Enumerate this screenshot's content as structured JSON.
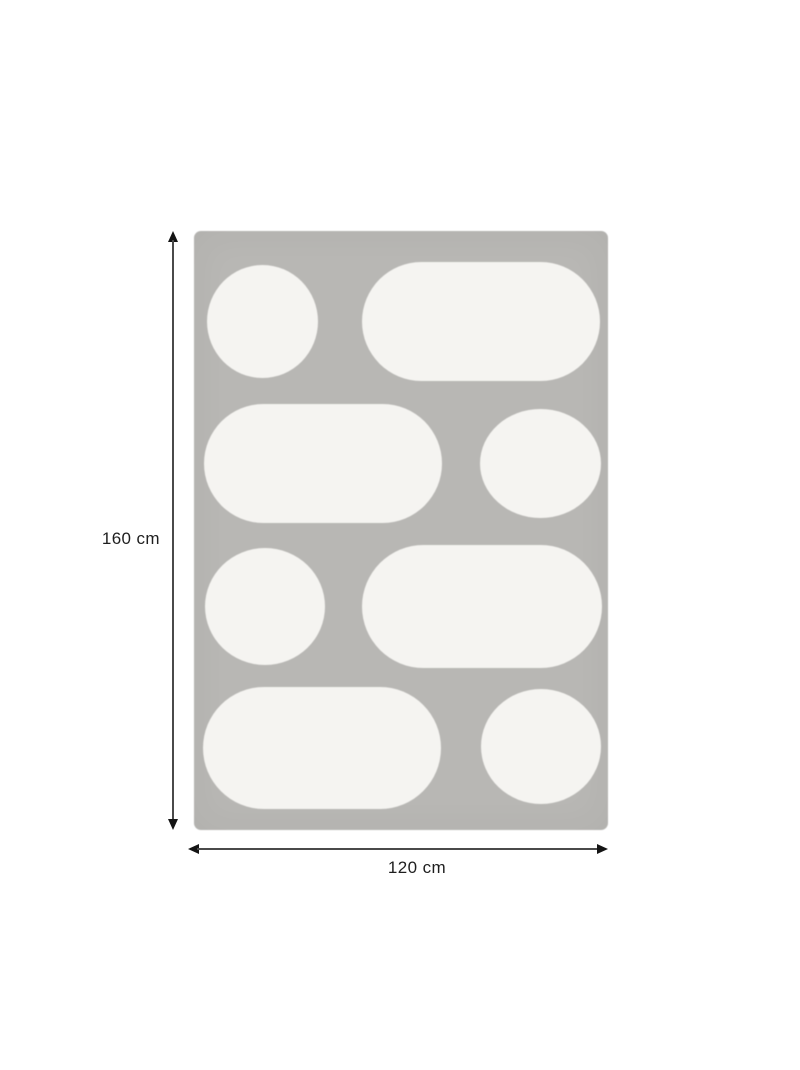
{
  "product": {
    "name": "patterned rug",
    "description": "Grey rectangular rug decorated with eight white rounded motifs (circles and pills) arranged in four rows",
    "pattern_rows": [
      [
        "circle",
        "pill"
      ],
      [
        "pill",
        "circle"
      ],
      [
        "circle",
        "pill"
      ],
      [
        "pill",
        "circle"
      ]
    ]
  },
  "dimensions": {
    "height_label": "160 cm",
    "width_label": "120 cm"
  },
  "colors": {
    "background": "#ffffff",
    "rug": "#b8b7b4",
    "motif": "#f5f4f1",
    "dimension_line": "#4a4a4a",
    "arrowhead": "#141414",
    "label_text": "#1e1e1e"
  }
}
